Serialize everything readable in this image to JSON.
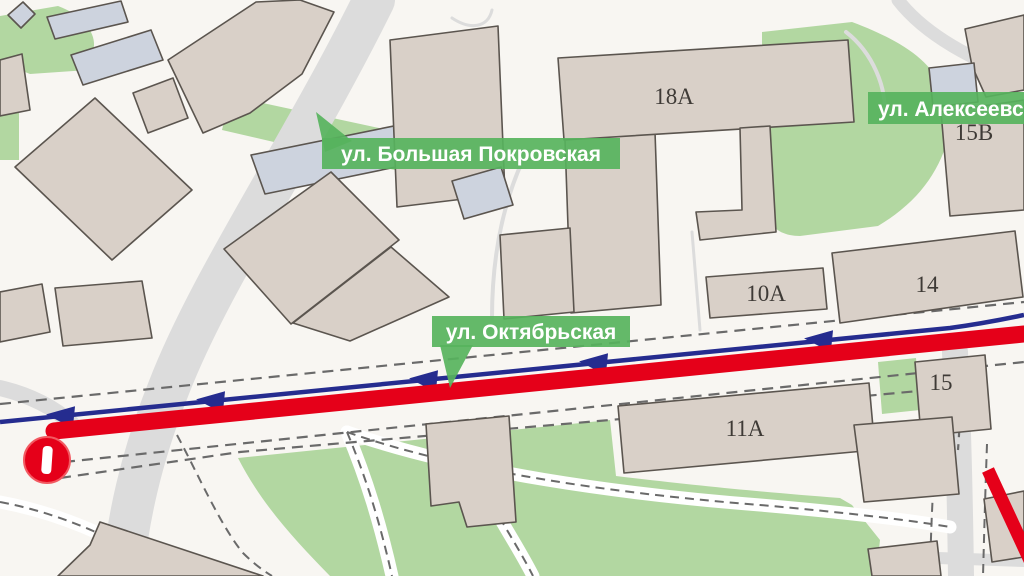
{
  "map": {
    "title": "Схема перекрытия движения: ул. Октябрьская",
    "street_labels": [
      {
        "id": "bolshaya-pokrovskaya",
        "text": "ул. Большая Покровская"
      },
      {
        "id": "oktyabrskaya",
        "text": "ул. Октябрьская"
      },
      {
        "id": "alekseevskaya",
        "text": "ул. Алексеевская"
      }
    ],
    "building_numbers": [
      {
        "id": "b18a",
        "text": "18А"
      },
      {
        "id": "b10a",
        "text": "10А"
      },
      {
        "id": "b14",
        "text": "14"
      },
      {
        "id": "b15v",
        "text": "15В"
      },
      {
        "id": "b15",
        "text": "15"
      },
      {
        "id": "b11a",
        "text": "11А"
      }
    ],
    "icons": [
      {
        "name": "no-entry-icon"
      },
      {
        "name": "direction-arrow-icon",
        "count": 5,
        "direction": "west"
      }
    ],
    "colors": {
      "route_red": "#e50019",
      "direction_blue": "#252c8f",
      "label_green": "#57b35d",
      "park_green": "#b2d7a1",
      "building_fill": "#d9d0c8",
      "building_stroke": "#5b554f",
      "road_gray": "#dcdcdc",
      "background": "#f8f6f2"
    }
  }
}
